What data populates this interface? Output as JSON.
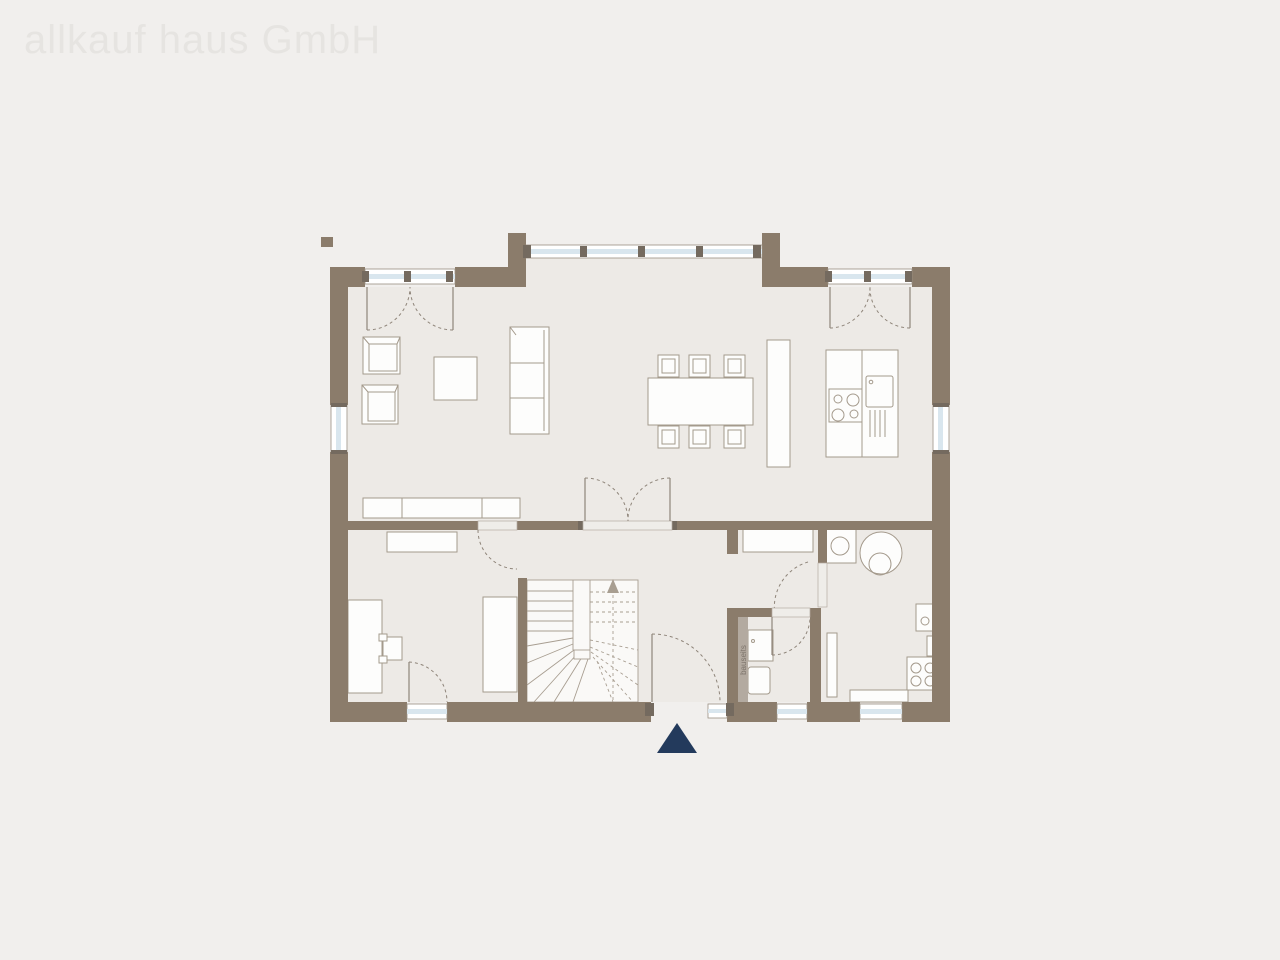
{
  "watermark": {
    "text": "allkauf haus GmbH"
  },
  "labels": {
    "bauseits": "bauseits"
  },
  "colors": {
    "background": "#f1efed",
    "floor": "#edeae6",
    "wall": "#8b7c6b",
    "jamb": "#746a5f",
    "glazing": "#d9e6ee",
    "furniture-line": "#a49a8c",
    "door-line": "#8f857a",
    "stair-line": "#a89e91",
    "entrance-marker": "#233a5c",
    "bauseits-strip": "#b3aaa0",
    "watermark": "#e6e4e1"
  }
}
